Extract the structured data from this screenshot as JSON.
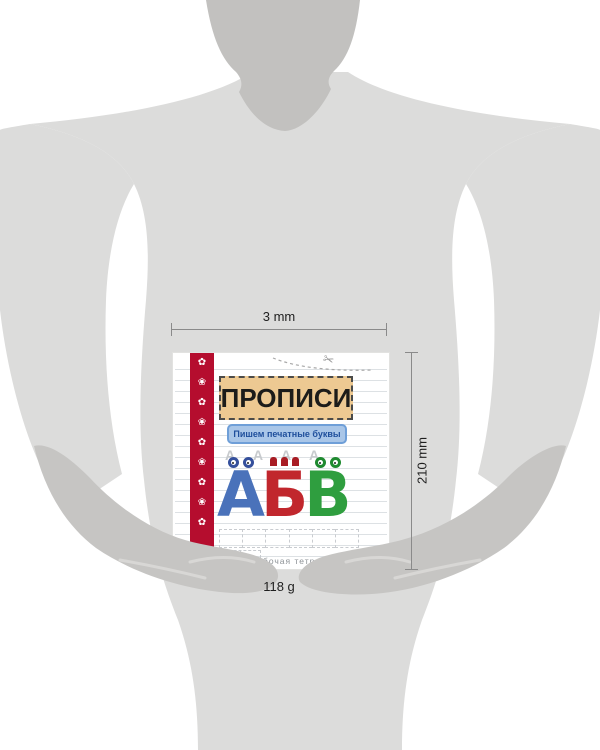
{
  "annotations": {
    "width_label": "3 mm",
    "height_label": "210 mm",
    "weight_label": "118 g"
  },
  "book_cover": {
    "title": "ПРОПИСИ",
    "subtitle": "Пишем печатные буквы",
    "trace_letters": "А А А А",
    "letters": [
      {
        "char": "А",
        "color": "#4a72ba",
        "eye_color": "#35509c"
      },
      {
        "char": "Б",
        "color": "#c1272d",
        "eye_color": "#a81c24"
      },
      {
        "char": "В",
        "color": "#2f9e3f",
        "eye_color": "#1f8a30"
      }
    ],
    "footer": "рабочая тетрадь",
    "strip_ornaments": "✿ ❀ ✿ ❀ ✿ ❀ ✿ ❀ ✿",
    "colors": {
      "strip": "#b50d2e",
      "title_box": "#edc992",
      "subtitle_box": "#a9c6e8",
      "subtitle_text": "#1f4f9c"
    }
  },
  "icons": {
    "scissors": "✂"
  },
  "silhouette_colors": {
    "head": "#c2c1bf",
    "shirt": "#dcdcdb",
    "skin": "#c6c5c3",
    "hand_highlight": "#d8d7d5"
  }
}
